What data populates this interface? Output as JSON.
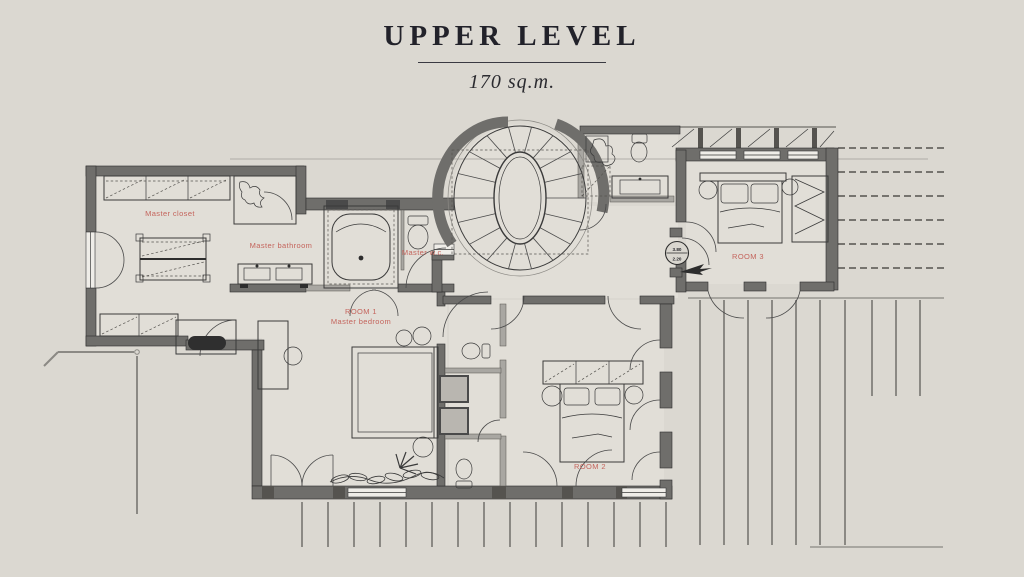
{
  "header": {
    "title": "UPPER LEVEL",
    "area": "170 sq.m."
  },
  "rooms": {
    "master_closet": "Master closet",
    "master_bathroom": "Master bathroom",
    "master_wc": "Master w.c.",
    "room1_line1": "ROOM 1",
    "room1_line2": "Master bedroom",
    "room2": "ROOM 2",
    "room3": "ROOM 3"
  },
  "level_marker": {
    "upper": "3.80",
    "lower": "2.20"
  },
  "colors": {
    "background": "#DBD8D1",
    "wall": "#6F6E6B",
    "wall_light": "#A9A7A2",
    "drawing_line": "#3A3A3A",
    "room_label": "#C4645C",
    "title_text": "#22222A"
  }
}
